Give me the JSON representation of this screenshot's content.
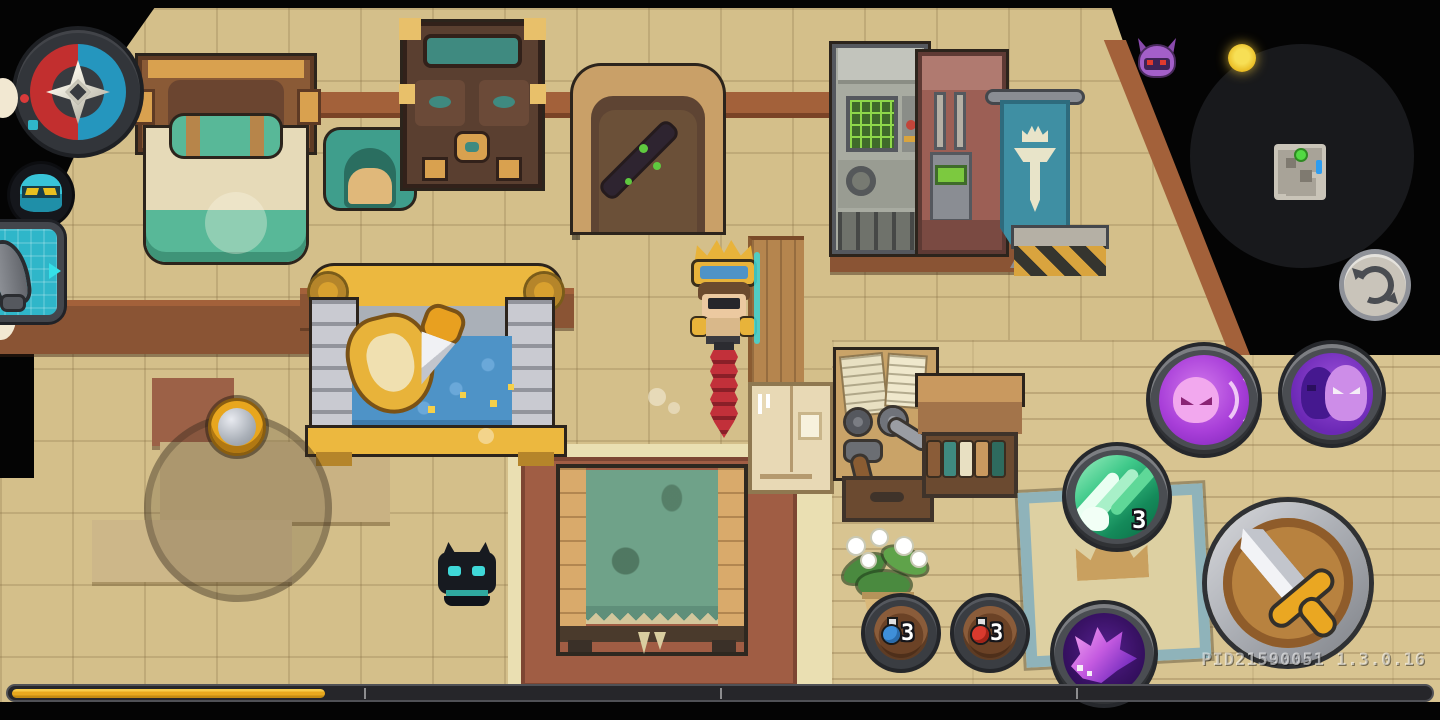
{
  "hud": {
    "version_text": "PID21590051 1.3.0.16",
    "counts": {
      "claw_skill_charges": "3",
      "blue_potion": "3",
      "red_potion": "3"
    },
    "progress_bar": {
      "percent_filled": 22,
      "segments": 4,
      "fill_color": "#e8a81e"
    },
    "minimap": {
      "player_marker": "green-dot",
      "exit_marker": "blue-tick"
    },
    "icons": {
      "compass": "compass-rose",
      "pet_portrait": "cyan-pet-face",
      "weapon_slot": "gray-blade",
      "enemy_indicator": "purple-bat",
      "pickup_indicator": "gold-coin",
      "camera_reset": "refresh-arrows",
      "skill_ghost_dash": "pink-ghost-afterimage",
      "skill_twin_ghost": "twin-ghosts",
      "skill_claw": "green-claw-slash",
      "skill_beast": "purple-beast-head",
      "attack_button": "pixel-sword",
      "item_blue": "blue-potion",
      "item_red": "red-potion"
    },
    "colors": {
      "gold": "#e8a81e",
      "hud_teal": "#2fb6c9",
      "skill_purple": "#a93fd9",
      "claw_green": "#148a5a",
      "compass_red": "#c22f2f",
      "compass_blue": "#2596be"
    }
  }
}
